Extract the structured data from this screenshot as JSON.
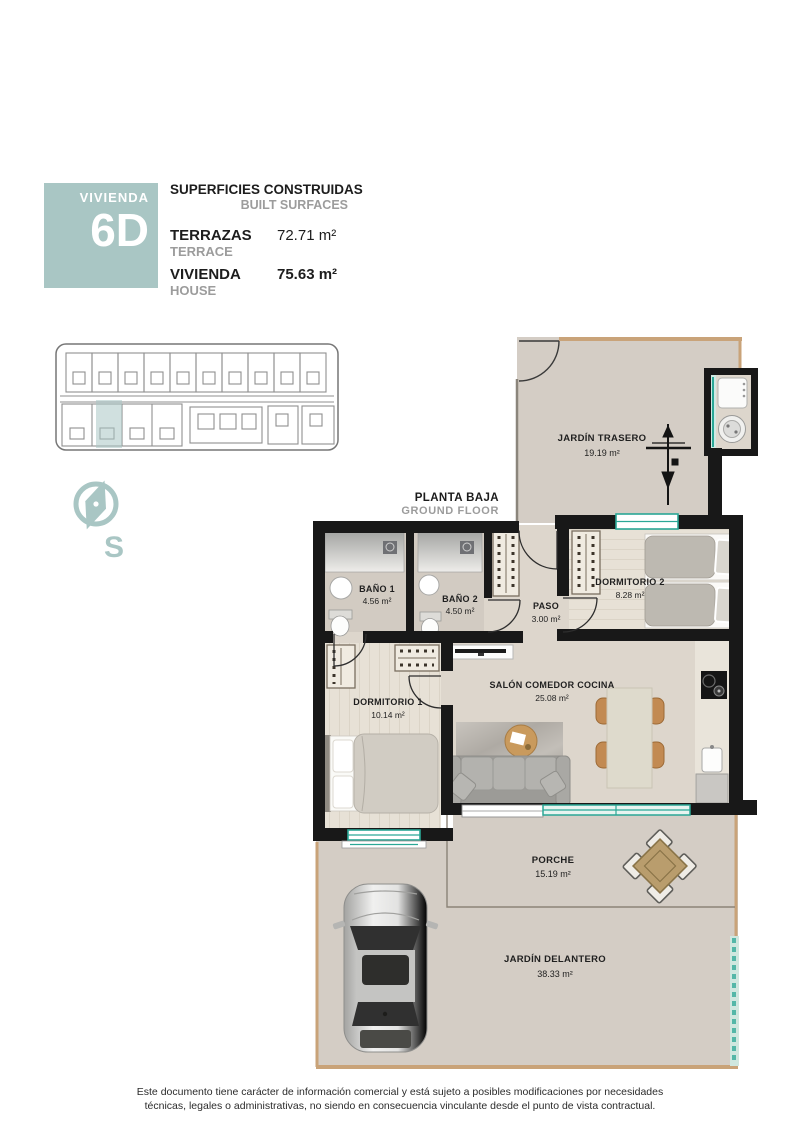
{
  "header": {
    "box_label": "VIVIENDA",
    "box_unit": "6D",
    "title": "SUPERFICIES CONSTRUIDAS",
    "subtitle": "BUILT SURFACES",
    "rows": [
      {
        "label": "TERRAZAS",
        "sublabel": "TERRACE",
        "value": "72.71 m²"
      },
      {
        "label": "VIVIENDA",
        "sublabel": "HOUSE",
        "value": "75.63 m²"
      }
    ]
  },
  "plan": {
    "floor_label": "PLANTA BAJA",
    "floor_sublabel": "GROUND FLOOR",
    "compass_letter": "S",
    "rooms": {
      "jardin_trasero": {
        "name": "JARDÍN TRASERO",
        "area": "19.19 m²"
      },
      "dormitorio2": {
        "name": "DORMITORIO 2",
        "area": "8.28 m²"
      },
      "bano1": {
        "name": "BAÑO 1",
        "area": "4.56 m²"
      },
      "bano2": {
        "name": "BAÑO 2",
        "area": "4.50 m²"
      },
      "paso": {
        "name": "PASO",
        "area": "3.00 m²"
      },
      "dormitorio1": {
        "name": "DORMITORIO 1",
        "area": "10.14 m²"
      },
      "salon": {
        "name": "SALÓN COMEDOR COCINA",
        "area": "25.08 m²"
      },
      "porche": {
        "name": "PORCHE",
        "area": "15.19 m²"
      },
      "jardin_delantero": {
        "name": "JARDÍN DELANTERO",
        "area": "38.33 m²"
      }
    }
  },
  "footer": {
    "line1": "Este documento tiene carácter de información comercial y está sujeto a posibles modificaciones por necesidades",
    "line2": "técnicas, legales o administrativas, no siendo en consecuencia vinculante desde el punto de vista contractual."
  },
  "colors": {
    "accent": "#a9c6c4",
    "glazing": "#2aa796",
    "wall": "#181818",
    "outdoor": "#d4cdc5",
    "tan_wall": "#c9a379"
  }
}
